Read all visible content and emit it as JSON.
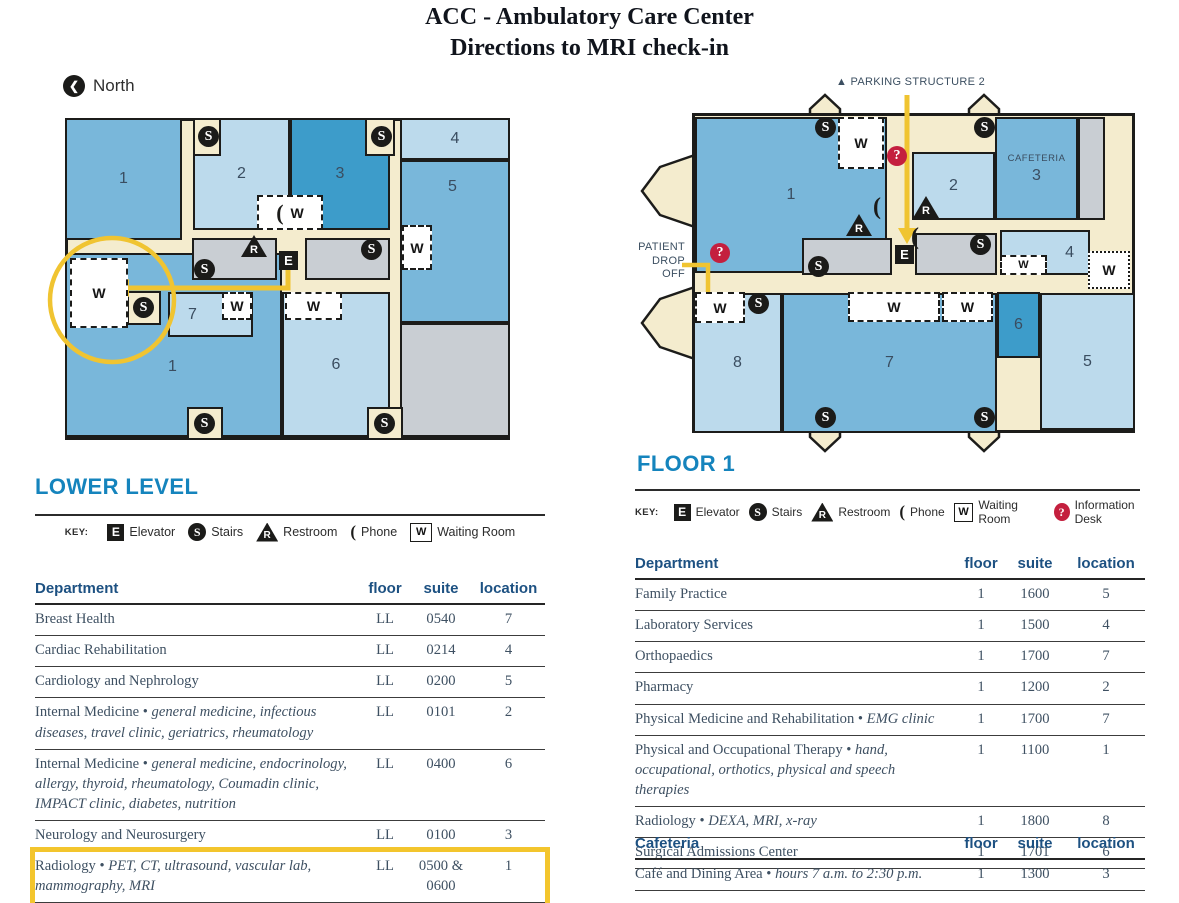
{
  "page_title": {
    "line1": "ACC - Ambulatory Care Center",
    "line2": "Directions to MRI check-in"
  },
  "icons": {
    "elevator": "E",
    "stairs": "S",
    "restroom": "R",
    "waiting": "W",
    "information": "?",
    "phone": "(",
    "north_arrow": "❮",
    "parking_marker": "▲"
  },
  "colors": {
    "room_medium_blue": "#79b7da",
    "room_light_blue": "#bcdaec",
    "room_dark_blue": "#3d9cca",
    "room_gray": "#c9ced3",
    "corridor_cream": "#f4ecce",
    "route_yellow": "#f0c431",
    "info_red": "#c41f3e",
    "heading_blue": "#1584bd",
    "table_header_blue": "#1d5182"
  },
  "lower_level": {
    "heading": "LOWER LEVEL",
    "north_label": "North",
    "key_label": "KEY:",
    "key_items": [
      {
        "icon": "elevator",
        "label": "Elevator"
      },
      {
        "icon": "stairs",
        "label": "Stairs"
      },
      {
        "icon": "restroom",
        "label": "Restroom"
      },
      {
        "icon": "phone",
        "label": "Phone"
      },
      {
        "icon": "waiting",
        "label": "Waiting Room"
      }
    ],
    "rooms": {
      "one_top": "1",
      "two": "2",
      "three": "3",
      "four": "4",
      "five": "5",
      "one_bottom": "1",
      "six": "6",
      "seven": "7"
    },
    "table": {
      "headers": {
        "department": "Department",
        "floor": "floor",
        "suite": "suite",
        "location": "location"
      },
      "rows": [
        {
          "name": "Breast Health",
          "desc": "",
          "floor": "LL",
          "suite": "0540",
          "location": "7"
        },
        {
          "name": "Cardiac Rehabilitation",
          "desc": "",
          "floor": "LL",
          "suite": "0214",
          "location": "4"
        },
        {
          "name": "Cardiology and Nephrology",
          "desc": "",
          "floor": "LL",
          "suite": "0200",
          "location": "5"
        },
        {
          "name": "Internal Medicine",
          "desc": "general medicine, infectious diseases, travel clinic, geriatrics, rheumatology",
          "floor": "LL",
          "suite": "0101",
          "location": "2"
        },
        {
          "name": "Internal Medicine",
          "desc": "general medicine, endocrinology, allergy, thyroid, rheumatology, Coumadin clinic, IMPACT clinic, diabetes, nutrition",
          "floor": "LL",
          "suite": "0400",
          "location": "6"
        },
        {
          "name": "Neurology and Neurosurgery",
          "desc": "",
          "floor": "LL",
          "suite": "0100",
          "location": "3"
        },
        {
          "name": "Radiology",
          "desc": "PET, CT, ultrasound, vascular lab, mammography, MRI",
          "floor": "LL",
          "suite": "0500 & 0600",
          "location": "1",
          "highlight": true
        }
      ]
    }
  },
  "floor_1": {
    "heading": "FLOOR 1",
    "parking_label": "PARKING STRUCTURE 2",
    "patient_drop_off_line1": "PATIENT",
    "patient_drop_off_line2": "DROP OFF",
    "cafeteria_room_label": "CAFETERIA",
    "key_label": "KEY:",
    "key_items": [
      {
        "icon": "elevator",
        "label": "Elevator"
      },
      {
        "icon": "stairs",
        "label": "Stairs"
      },
      {
        "icon": "restroom",
        "label": "Restroom"
      },
      {
        "icon": "phone",
        "label": "Phone"
      },
      {
        "icon": "waiting",
        "label": "Waiting Room"
      },
      {
        "icon": "information",
        "label": "Information Desk"
      }
    ],
    "rooms": {
      "one": "1",
      "two": "2",
      "three": "3",
      "four": "4",
      "five": "5",
      "six": "6",
      "seven": "7",
      "eight": "8"
    },
    "table": {
      "headers": {
        "department": "Department",
        "floor": "floor",
        "suite": "suite",
        "location": "location"
      },
      "rows": [
        {
          "name": "Family Practice",
          "desc": "",
          "floor": "1",
          "suite": "1600",
          "location": "5"
        },
        {
          "name": "Laboratory Services",
          "desc": "",
          "floor": "1",
          "suite": "1500",
          "location": "4"
        },
        {
          "name": "Orthopaedics",
          "desc": "",
          "floor": "1",
          "suite": "1700",
          "location": "7"
        },
        {
          "name": "Pharmacy",
          "desc": "",
          "floor": "1",
          "suite": "1200",
          "location": "2"
        },
        {
          "name": "Physical Medicine and Rehabilitation",
          "desc": "EMG clinic",
          "floor": "1",
          "suite": "1700",
          "location": "7"
        },
        {
          "name": "Physical and Occupational Therapy",
          "desc": "hand, occupational, orthotics, physical and speech therapies",
          "floor": "1",
          "suite": "1100",
          "location": "1"
        },
        {
          "name": "Radiology",
          "desc": "DEXA, MRI, x-ray",
          "floor": "1",
          "suite": "1800",
          "location": "8"
        },
        {
          "name": "Surgical Admissions Center",
          "desc": "",
          "floor": "1",
          "suite": "1701",
          "location": "6"
        }
      ]
    },
    "cafeteria_table": {
      "headers": {
        "department": "Cafeteria",
        "floor": "floor",
        "suite": "suite",
        "location": "location"
      },
      "rows": [
        {
          "name": "Café and Dining Area",
          "desc": "hours 7 a.m. to 2:30 p.m.",
          "floor": "1",
          "suite": "1300",
          "location": "3"
        }
      ]
    }
  }
}
